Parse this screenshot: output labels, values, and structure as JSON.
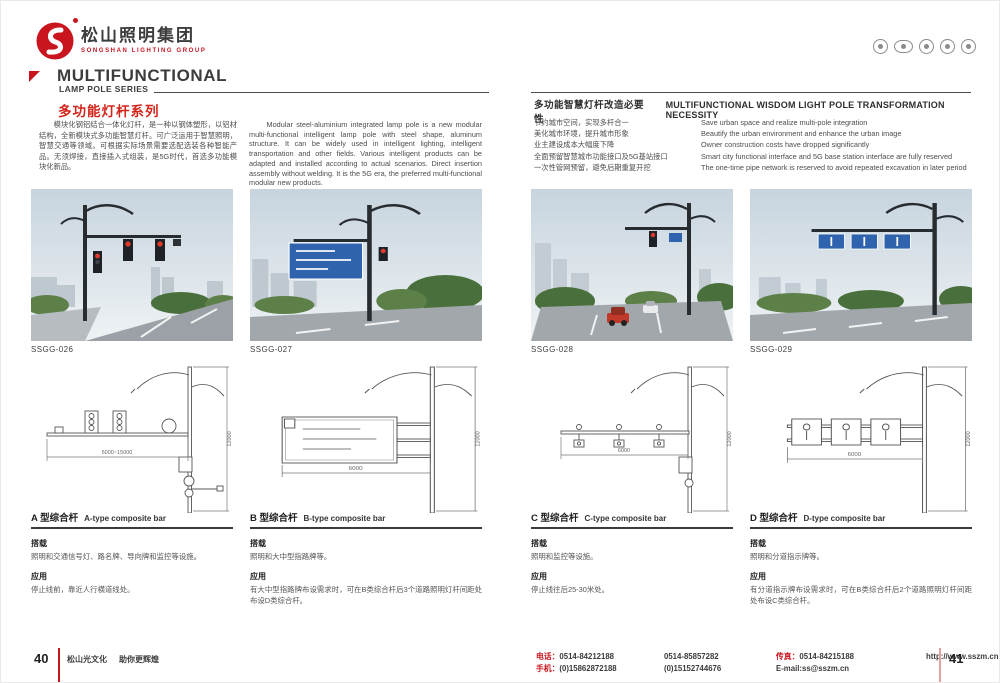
{
  "colors": {
    "accent_red": "#c9151e",
    "heading_red": "#d3251c",
    "sign_blue": "#2f63ae",
    "heading_dark": "#3c3c3c",
    "body_gray": "#555555"
  },
  "brand": {
    "company_cn": "松山照明集团",
    "company_en": "SONGSHAN LIGHTING GROUP"
  },
  "header": {
    "series_en_line1": "MULTIFUNCTIONAL",
    "series_en_line2": "LAMP POLE SERIES",
    "series_cn": "多功能灯杆系列",
    "cert_icons": [
      "cert-badge-1",
      "cert-badge-2",
      "cert-badge-3",
      "cert-badge-4",
      "cert-badge-5"
    ]
  },
  "intro": {
    "cn": "模块化钢铝结合一体化灯杆，是一种以钢体塑形，以铝材结构，全新模块式多功能智慧灯杆。可广泛运用于智慧照明，智慧交通等领域。可根据实际场景需要选配选装各种智能产品。无须焊接，直接插入式组装，是5G时代，首选多功能模块化新品。",
    "en": "Modular steel-aluminium integrated lamp pole is a new modular multi-functional intelligent lamp pole with steel shape, aluminum structure. It can be widely used in intelligent lighting, intelligent transportation and other fields. Various intelligent products can be adapted and installed according to actual scenarios. Direct insertion assembly without welding. It is the 5G era, the preferred multi-functional modular new products."
  },
  "necessity": {
    "title_cn": "多功能智慧灯杆改造必要性",
    "title_en": "MULTIFUNCTIONAL WISDOM LIGHT POLE TRANSFORMATION NECESSITY",
    "items_cn": [
      "节约城市空间，实现多杆合一",
      "美化城市环境，提升城市形象",
      "业主建设成本大幅度下降",
      "全面预留智慧城市功能接口及5G基站接口",
      "一次性管网预留，避免后期重复开挖"
    ],
    "items_en": [
      "Save urban space and realize multi-pole integration",
      "Beautify the urban environment and enhance the urban image",
      "Owner construction costs have dropped significantly",
      "Smart city functional interface and 5G base station interface are fully reserved",
      "The one-time pipe network is reserved to avoid repeated excavation in later period"
    ]
  },
  "photos": [
    {
      "code": "SSGG-026"
    },
    {
      "code": "SSGG-027"
    },
    {
      "code": "SSGG-028"
    },
    {
      "code": "SSGG-029"
    }
  ],
  "labels": {
    "carry": "搭载",
    "app": "应用"
  },
  "poles": [
    {
      "title_cn": "A 型综合杆",
      "title_en": "A-type composite bar",
      "carry": "照明和交通信号灯、路名牌、导向牌和监控等设施。",
      "app": "停止线前，靠近人行横道线处。",
      "dim_h": "5000~15000",
      "dim_v": "12000"
    },
    {
      "title_cn": "B 型综合杆",
      "title_en": "B-type composite bar",
      "carry": "照明和大中型指路牌等。",
      "app": "有大中型指路牌布设需求时，可在B类综合杆后3个道路照明灯杆间距处布设D类综合杆。",
      "dim_h": "6000",
      "dim_v": "12000"
    },
    {
      "title_cn": "C 型综合杆",
      "title_en": "C-type composite bar",
      "carry": "照明和监控等设施。",
      "app": "停止线往后25-30米处。",
      "dim_h": "6000",
      "dim_v": "12000"
    },
    {
      "title_cn": "D 型综合杆",
      "title_en": "D-type composite bar",
      "carry": "照明和分道指示牌等。",
      "app": "有分道指示牌布设需求时，可在B类综合杆后2个道路照明灯杆间距处布设C类综合杆。",
      "dim_h": "6000",
      "dim_v": "12000"
    }
  ],
  "footer": {
    "page_left": "40",
    "page_right": "41",
    "slogan_part1": "松山光文化",
    "slogan_part2": "助你更辉煌",
    "tel_label": "电话：",
    "tel_1": "0514-84212188",
    "tel_2": "0514-85857282",
    "fax_label": "传真：",
    "fax": "0514-84215188",
    "mobile_label": "手机：",
    "mobile_1": "(0)15862872188",
    "mobile_2": "(0)15152744676",
    "email": "E-mail:ss@sszm.cn",
    "website": "http://www.sszm.cn"
  }
}
